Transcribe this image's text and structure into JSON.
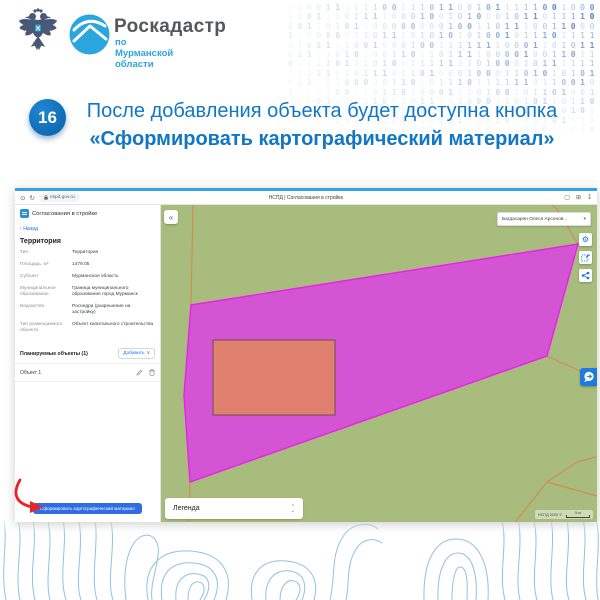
{
  "brand": {
    "org_name": "Роскадастр",
    "org_region": "по Мурманской области"
  },
  "step": {
    "number": "16",
    "text_regular": "После добавления объекта будет доступна кнопка ",
    "text_bold": "«Сформировать картографический материал»"
  },
  "binary_rows": [
    "100011111100111011001011111001000",
    "010111011110001001010001011011110",
    "101101011000000001001101110011000",
    "110000011011101010101001011101111",
    "010111100100010011111110001101011",
    "011010101001101101111000010011011",
    "001110101010011111110100010111111",
    "111110101110110100010001101010101",
    "011101000001101011101111110110010",
    "101010011011010001110100101101001",
    "010011101100101110100011010110110",
    "110101001011100101001101011100101",
    "001011010111001010110010110101011",
    "101100101001110110101011001011010"
  ],
  "browser": {
    "url": "nspd.gov.ru",
    "tab_title": "НСПД | Согласования в стройке"
  },
  "app": {
    "panel": {
      "header": "Согласования в стройке",
      "back": "Назад",
      "section_title": "Территория",
      "fields": [
        {
          "label": "Тип",
          "value": "Территория"
        },
        {
          "label": "Площадь, м²",
          "value": "1479.05"
        },
        {
          "label": "Субъект",
          "value": "Мурманская область"
        },
        {
          "label": "Муниципальное образование",
          "value": "Граница муниципального образования город Мурманск"
        },
        {
          "label": "Ведомство",
          "value": "Роснедра (разрешение на застройку)"
        },
        {
          "label": "Тип размещаемого объекта",
          "value": "Объект капитального строительства"
        }
      ],
      "planned_objects_title": "Планируемые объекты (1)",
      "add_button": "Добавить",
      "object_item": "Объект 1",
      "generate_button": "Сформировать картографический материал"
    },
    "map": {
      "user_name": "Багдасарян Олеся Арсенов...",
      "legend_label": "Легенда",
      "attribution": "НСПД 2025 ©",
      "scale_label": "5 м",
      "colors": {
        "land": "#a8bd7d",
        "parcel_line": "#cf8d52",
        "polygon_fill": "#d455d4",
        "polygon_stroke": "#ea1fea",
        "object_fill": "#e08170",
        "object_stroke": "#6b4f48"
      }
    }
  },
  "glyphs": {
    "collapse": "«",
    "back_chevron": "‹",
    "caret_down": "▾",
    "chevron_down": "∨",
    "sort_up": "⌃",
    "sort_down": "⌄",
    "page_info": "⊙",
    "reload": "↻",
    "bookmark": "▢",
    "extensions": "⊞",
    "download": "↧",
    "gear": "⚙"
  },
  "colors": {
    "accent_blue": "#1177c5",
    "step_circle_blue": "#0e63ad",
    "button_blue": "#2e6de4",
    "arrow_red": "#e4232a",
    "binary_blue": "#336fbd",
    "logo_blue": "#2aa5dd",
    "logo_gray": "#55575c",
    "contour_blue": "#8fc2e2"
  }
}
